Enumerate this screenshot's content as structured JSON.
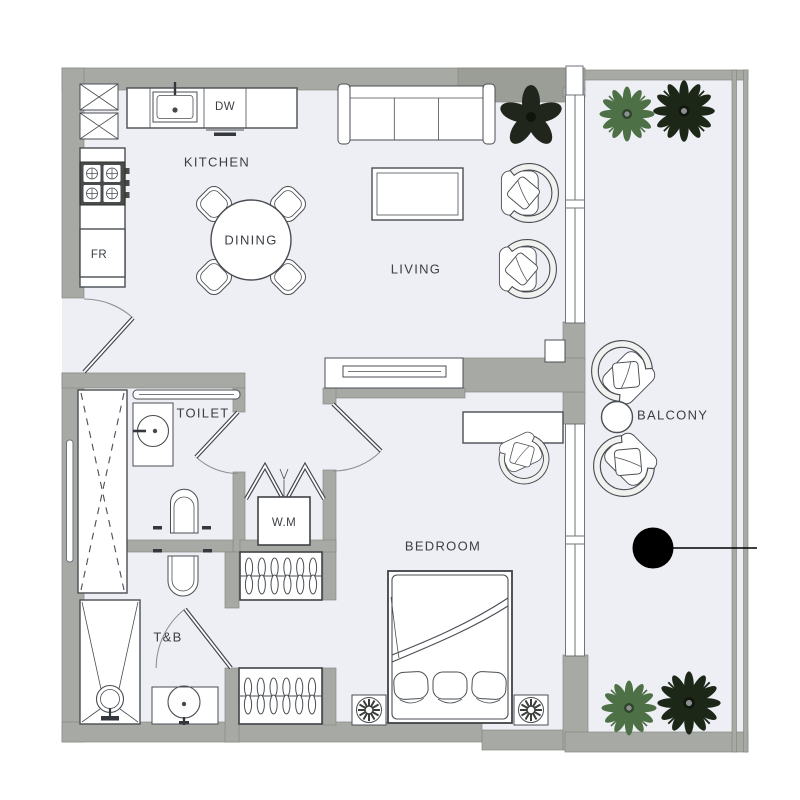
{
  "floorplan": {
    "labels": {
      "kitchen": "KITCHEN",
      "dining": "DINING",
      "living": "LIVING",
      "bedroom": "BEDROOM",
      "toilet": "TOILET",
      "tb": "T&B",
      "balcony": "BALCONY"
    },
    "appliances": {
      "dishwasher": "DW",
      "fridge": "FR",
      "washing_machine": "W.M"
    },
    "colors": {
      "wall": "#a7aaa4",
      "floor": "#edeff5",
      "line": "#4a4e53",
      "plant_light": "#4e7046",
      "plant_dark": "#1d2717",
      "marker": "#000000"
    }
  }
}
